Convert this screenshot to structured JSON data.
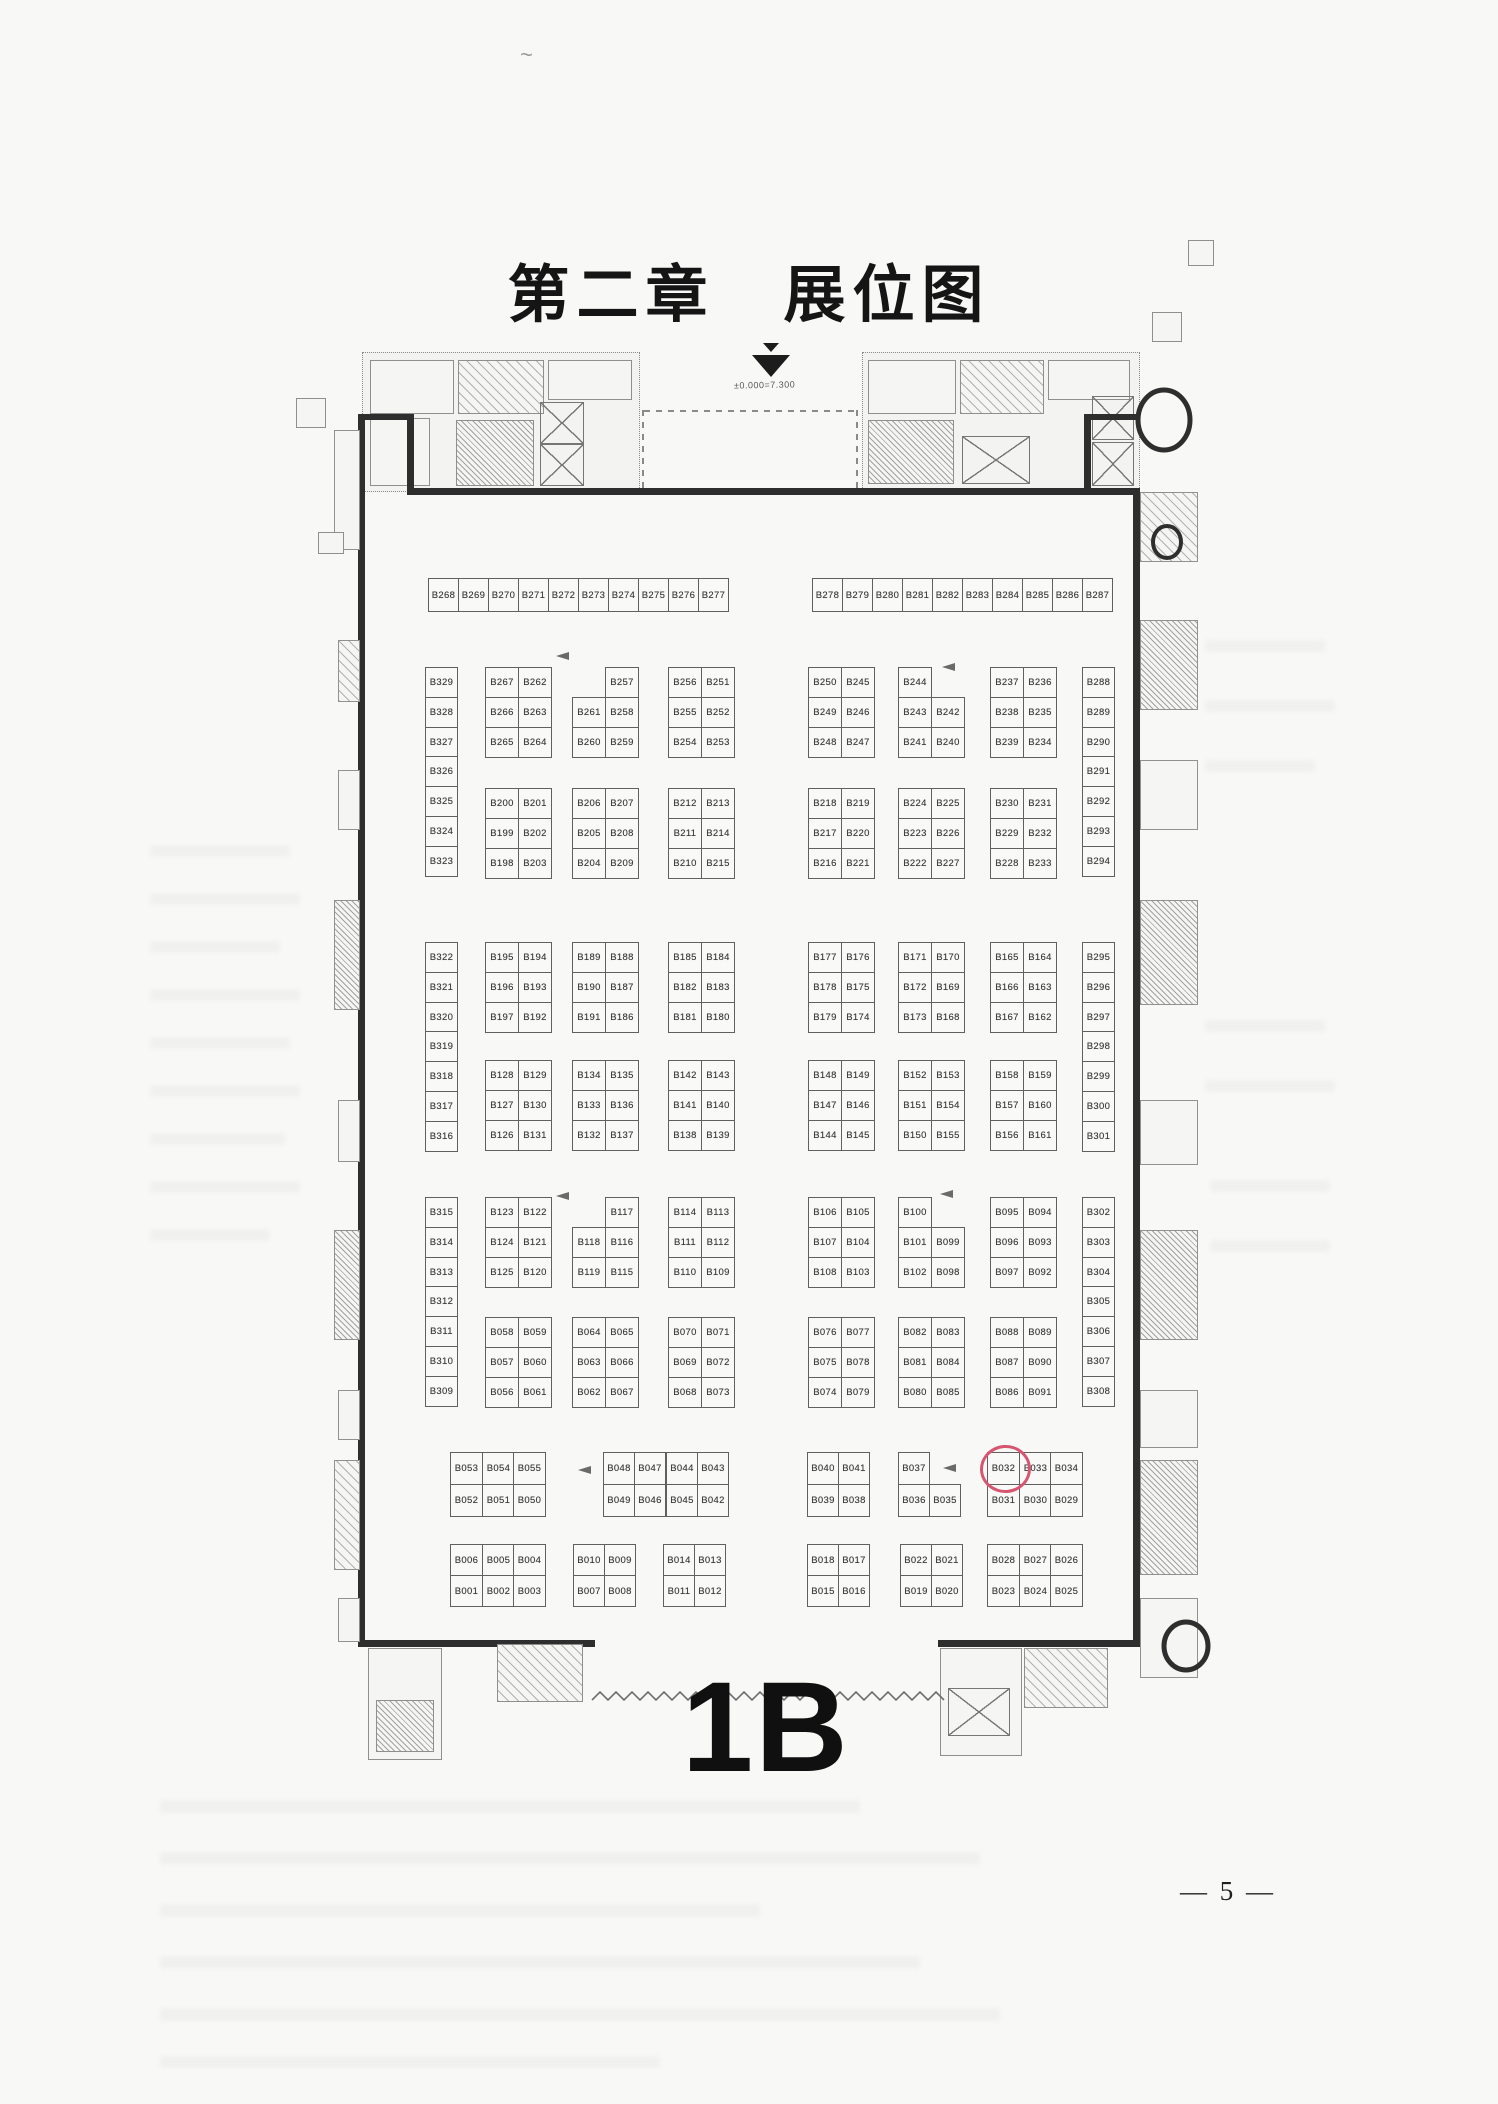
{
  "page": {
    "title": "第二章　展位图",
    "page_number": "— 5 —"
  },
  "plan": {
    "hall_label": "1B",
    "elevation_note": "±0.000=7.300",
    "highlight": {
      "booth": "B032",
      "color": "#d85570"
    },
    "blocks": [
      {
        "name": "top-row-left",
        "x": 428,
        "y": 578,
        "cw": 30,
        "ch": 33,
        "cells": [
          [
            "B268",
            "B269",
            "B270",
            "B271",
            "B272",
            "B273",
            "B274",
            "B275",
            "B276",
            "B277"
          ]
        ]
      },
      {
        "name": "top-row-right",
        "x": 812,
        "y": 578,
        "cw": 30,
        "ch": 33,
        "cells": [
          [
            "B278",
            "B279",
            "B280",
            "B281",
            "B282",
            "B283",
            "B284",
            "B285",
            "B286",
            "B287"
          ]
        ]
      },
      {
        "name": "strip-left-a",
        "x": 425,
        "y": 667,
        "cw": 32,
        "ch": 29.8,
        "cells": [
          [
            "B329"
          ],
          [
            "B328"
          ],
          [
            "B327"
          ],
          [
            "B326"
          ],
          [
            "B325"
          ],
          [
            "B324"
          ],
          [
            "B323"
          ]
        ]
      },
      {
        "name": "a1",
        "x": 485,
        "y": 667,
        "cw": 33,
        "ch": 30,
        "cells": [
          [
            "B267",
            "B262"
          ],
          [
            "B266",
            "B263"
          ],
          [
            "B265",
            "B264"
          ]
        ]
      },
      {
        "name": "a2",
        "x": 572,
        "y": 667,
        "cw": 33,
        "ch": 30,
        "cells": [
          [
            null,
            "B257"
          ],
          [
            "B261",
            "B258"
          ],
          [
            "B260",
            "B259"
          ]
        ]
      },
      {
        "name": "a3",
        "x": 668,
        "y": 667,
        "cw": 33,
        "ch": 30,
        "cells": [
          [
            "B256",
            "B251"
          ],
          [
            "B255",
            "B252"
          ],
          [
            "B254",
            "B253"
          ]
        ]
      },
      {
        "name": "a4",
        "x": 808,
        "y": 667,
        "cw": 33,
        "ch": 30,
        "cells": [
          [
            "B250",
            "B245"
          ],
          [
            "B249",
            "B246"
          ],
          [
            "B248",
            "B247"
          ]
        ]
      },
      {
        "name": "a5",
        "x": 898,
        "y": 667,
        "cw": 33,
        "ch": 30,
        "cells": [
          [
            "B244",
            null
          ],
          [
            "B243",
            "B242"
          ],
          [
            "B241",
            "B240"
          ]
        ]
      },
      {
        "name": "a6",
        "x": 990,
        "y": 667,
        "cw": 33,
        "ch": 30,
        "cells": [
          [
            "B237",
            "B236"
          ],
          [
            "B238",
            "B235"
          ],
          [
            "B239",
            "B234"
          ]
        ]
      },
      {
        "name": "strip-right-a",
        "x": 1082,
        "y": 667,
        "cw": 32,
        "ch": 29.8,
        "cells": [
          [
            "B288"
          ],
          [
            "B289"
          ],
          [
            "B290"
          ],
          [
            "B291"
          ],
          [
            "B292"
          ],
          [
            "B293"
          ],
          [
            "B294"
          ]
        ]
      },
      {
        "name": "a7",
        "x": 485,
        "y": 788,
        "cw": 33,
        "ch": 30,
        "cells": [
          [
            "B200",
            "B201"
          ],
          [
            "B199",
            "B202"
          ],
          [
            "B198",
            "B203"
          ]
        ]
      },
      {
        "name": "a8",
        "x": 572,
        "y": 788,
        "cw": 33,
        "ch": 30,
        "cells": [
          [
            "B206",
            "B207"
          ],
          [
            "B205",
            "B208"
          ],
          [
            "B204",
            "B209"
          ]
        ]
      },
      {
        "name": "a9",
        "x": 668,
        "y": 788,
        "cw": 33,
        "ch": 30,
        "cells": [
          [
            "B212",
            "B213"
          ],
          [
            "B211",
            "B214"
          ],
          [
            "B210",
            "B215"
          ]
        ]
      },
      {
        "name": "a10",
        "x": 808,
        "y": 788,
        "cw": 33,
        "ch": 30,
        "cells": [
          [
            "B218",
            "B219"
          ],
          [
            "B217",
            "B220"
          ],
          [
            "B216",
            "B221"
          ]
        ]
      },
      {
        "name": "a11",
        "x": 898,
        "y": 788,
        "cw": 33,
        "ch": 30,
        "cells": [
          [
            "B224",
            "B225"
          ],
          [
            "B223",
            "B226"
          ],
          [
            "B222",
            "B227"
          ]
        ]
      },
      {
        "name": "a12",
        "x": 990,
        "y": 788,
        "cw": 33,
        "ch": 30,
        "cells": [
          [
            "B230",
            "B231"
          ],
          [
            "B229",
            "B232"
          ],
          [
            "B228",
            "B233"
          ]
        ]
      },
      {
        "name": "strip-left-b",
        "x": 425,
        "y": 942,
        "cw": 32,
        "ch": 29.8,
        "cells": [
          [
            "B322"
          ],
          [
            "B321"
          ],
          [
            "B320"
          ],
          [
            "B319"
          ],
          [
            "B318"
          ],
          [
            "B317"
          ],
          [
            "B316"
          ]
        ]
      },
      {
        "name": "b1",
        "x": 485,
        "y": 942,
        "cw": 33,
        "ch": 30,
        "cells": [
          [
            "B195",
            "B194"
          ],
          [
            "B196",
            "B193"
          ],
          [
            "B197",
            "B192"
          ]
        ]
      },
      {
        "name": "b2",
        "x": 572,
        "y": 942,
        "cw": 33,
        "ch": 30,
        "cells": [
          [
            "B189",
            "B188"
          ],
          [
            "B190",
            "B187"
          ],
          [
            "B191",
            "B186"
          ]
        ]
      },
      {
        "name": "b3",
        "x": 668,
        "y": 942,
        "cw": 33,
        "ch": 30,
        "cells": [
          [
            "B185",
            "B184"
          ],
          [
            "B182",
            "B183"
          ],
          [
            "B181",
            "B180"
          ]
        ]
      },
      {
        "name": "b4",
        "x": 808,
        "y": 942,
        "cw": 33,
        "ch": 30,
        "cells": [
          [
            "B177",
            "B176"
          ],
          [
            "B178",
            "B175"
          ],
          [
            "B179",
            "B174"
          ]
        ]
      },
      {
        "name": "b5",
        "x": 898,
        "y": 942,
        "cw": 33,
        "ch": 30,
        "cells": [
          [
            "B171",
            "B170"
          ],
          [
            "B172",
            "B169"
          ],
          [
            "B173",
            "B168"
          ]
        ]
      },
      {
        "name": "b6",
        "x": 990,
        "y": 942,
        "cw": 33,
        "ch": 30,
        "cells": [
          [
            "B165",
            "B164"
          ],
          [
            "B166",
            "B163"
          ],
          [
            "B167",
            "B162"
          ]
        ]
      },
      {
        "name": "strip-right-b",
        "x": 1082,
        "y": 942,
        "cw": 32,
        "ch": 29.8,
        "cells": [
          [
            "B295"
          ],
          [
            "B296"
          ],
          [
            "B297"
          ],
          [
            "B298"
          ],
          [
            "B299"
          ],
          [
            "B300"
          ],
          [
            "B301"
          ]
        ]
      },
      {
        "name": "b7",
        "x": 485,
        "y": 1060,
        "cw": 33,
        "ch": 30,
        "cells": [
          [
            "B128",
            "B129"
          ],
          [
            "B127",
            "B130"
          ],
          [
            "B126",
            "B131"
          ]
        ]
      },
      {
        "name": "b8",
        "x": 572,
        "y": 1060,
        "cw": 33,
        "ch": 30,
        "cells": [
          [
            "B134",
            "B135"
          ],
          [
            "B133",
            "B136"
          ],
          [
            "B132",
            "B137"
          ]
        ]
      },
      {
        "name": "b9",
        "x": 668,
        "y": 1060,
        "cw": 33,
        "ch": 30,
        "cells": [
          [
            "B142",
            "B143"
          ],
          [
            "B141",
            "B140"
          ],
          [
            "B138",
            "B139"
          ]
        ]
      },
      {
        "name": "b10",
        "x": 808,
        "y": 1060,
        "cw": 33,
        "ch": 30,
        "cells": [
          [
            "B148",
            "B149"
          ],
          [
            "B147",
            "B146"
          ],
          [
            "B144",
            "B145"
          ]
        ]
      },
      {
        "name": "b11",
        "x": 898,
        "y": 1060,
        "cw": 33,
        "ch": 30,
        "cells": [
          [
            "B152",
            "B153"
          ],
          [
            "B151",
            "B154"
          ],
          [
            "B150",
            "B155"
          ]
        ]
      },
      {
        "name": "b12",
        "x": 990,
        "y": 1060,
        "cw": 33,
        "ch": 30,
        "cells": [
          [
            "B158",
            "B159"
          ],
          [
            "B157",
            "B160"
          ],
          [
            "B156",
            "B161"
          ]
        ]
      },
      {
        "name": "strip-left-c",
        "x": 425,
        "y": 1197,
        "cw": 32,
        "ch": 29.8,
        "cells": [
          [
            "B315"
          ],
          [
            "B314"
          ],
          [
            "B313"
          ],
          [
            "B312"
          ],
          [
            "B311"
          ],
          [
            "B310"
          ],
          [
            "B309"
          ]
        ]
      },
      {
        "name": "c1",
        "x": 485,
        "y": 1197,
        "cw": 33,
        "ch": 30,
        "cells": [
          [
            "B123",
            "B122"
          ],
          [
            "B124",
            "B121"
          ],
          [
            "B125",
            "B120"
          ]
        ]
      },
      {
        "name": "c2",
        "x": 572,
        "y": 1197,
        "cw": 33,
        "ch": 30,
        "cells": [
          [
            null,
            "B117"
          ],
          [
            "B118",
            "B116"
          ],
          [
            "B119",
            "B115"
          ]
        ]
      },
      {
        "name": "c3",
        "x": 668,
        "y": 1197,
        "cw": 33,
        "ch": 30,
        "cells": [
          [
            "B114",
            "B113"
          ],
          [
            "B111",
            "B112"
          ],
          [
            "B110",
            "B109"
          ]
        ]
      },
      {
        "name": "c4",
        "x": 808,
        "y": 1197,
        "cw": 33,
        "ch": 30,
        "cells": [
          [
            "B106",
            "B105"
          ],
          [
            "B107",
            "B104"
          ],
          [
            "B108",
            "B103"
          ]
        ]
      },
      {
        "name": "c5",
        "x": 898,
        "y": 1197,
        "cw": 33,
        "ch": 30,
        "cells": [
          [
            "B100",
            null
          ],
          [
            "B101",
            "B099"
          ],
          [
            "B102",
            "B098"
          ]
        ]
      },
      {
        "name": "c6",
        "x": 990,
        "y": 1197,
        "cw": 33,
        "ch": 30,
        "cells": [
          [
            "B095",
            "B094"
          ],
          [
            "B096",
            "B093"
          ],
          [
            "B097",
            "B092"
          ]
        ]
      },
      {
        "name": "strip-right-c",
        "x": 1082,
        "y": 1197,
        "cw": 32,
        "ch": 29.8,
        "cells": [
          [
            "B302"
          ],
          [
            "B303"
          ],
          [
            "B304"
          ],
          [
            "B305"
          ],
          [
            "B306"
          ],
          [
            "B307"
          ],
          [
            "B308"
          ]
        ]
      },
      {
        "name": "c7",
        "x": 485,
        "y": 1317,
        "cw": 33,
        "ch": 30,
        "cells": [
          [
            "B058",
            "B059"
          ],
          [
            "B057",
            "B060"
          ],
          [
            "B056",
            "B061"
          ]
        ]
      },
      {
        "name": "c8",
        "x": 572,
        "y": 1317,
        "cw": 33,
        "ch": 30,
        "cells": [
          [
            "B064",
            "B065"
          ],
          [
            "B063",
            "B066"
          ],
          [
            "B062",
            "B067"
          ]
        ]
      },
      {
        "name": "c9",
        "x": 668,
        "y": 1317,
        "cw": 33,
        "ch": 30,
        "cells": [
          [
            "B070",
            "B071"
          ],
          [
            "B069",
            "B072"
          ],
          [
            "B068",
            "B073"
          ]
        ]
      },
      {
        "name": "c10",
        "x": 808,
        "y": 1317,
        "cw": 33,
        "ch": 30,
        "cells": [
          [
            "B076",
            "B077"
          ],
          [
            "B075",
            "B078"
          ],
          [
            "B074",
            "B079"
          ]
        ]
      },
      {
        "name": "c11",
        "x": 898,
        "y": 1317,
        "cw": 33,
        "ch": 30,
        "cells": [
          [
            "B082",
            "B083"
          ],
          [
            "B081",
            "B084"
          ],
          [
            "B080",
            "B085"
          ]
        ]
      },
      {
        "name": "c12",
        "x": 990,
        "y": 1317,
        "cw": 33,
        "ch": 30,
        "cells": [
          [
            "B088",
            "B089"
          ],
          [
            "B087",
            "B090"
          ],
          [
            "B086",
            "B091"
          ]
        ]
      },
      {
        "name": "d1",
        "x": 450,
        "y": 1452,
        "cw": 31.7,
        "ch": 32,
        "cells": [
          [
            "B053",
            "B054",
            "B055"
          ],
          [
            "B052",
            "B051",
            "B050"
          ]
        ]
      },
      {
        "name": "d2",
        "x": 603,
        "y": 1452,
        "cw": 31.3,
        "ch": 32,
        "cells": [
          [
            "B048",
            "B047",
            "B044",
            "B043"
          ],
          [
            "B049",
            "B046",
            "B045",
            "B042"
          ]
        ]
      },
      {
        "name": "d3",
        "x": 807,
        "y": 1452,
        "cw": 31,
        "ch": 32,
        "cells": [
          [
            "B040",
            "B041"
          ],
          [
            "B039",
            "B038"
          ]
        ]
      },
      {
        "name": "d4",
        "x": 898,
        "y": 1452,
        "cw": 31,
        "ch": 32,
        "cells": [
          [
            "B037",
            null
          ],
          [
            "B036",
            "B035"
          ]
        ]
      },
      {
        "name": "d5",
        "x": 987,
        "y": 1452,
        "cw": 31.7,
        "ch": 32,
        "cells": [
          [
            "B032",
            "B033",
            "B034"
          ],
          [
            "B031",
            "B030",
            "B029"
          ]
        ]
      },
      {
        "name": "e1",
        "x": 450,
        "y": 1544,
        "cw": 31.7,
        "ch": 31,
        "cells": [
          [
            "B006",
            "B005",
            "B004"
          ],
          [
            "B001",
            "B002",
            "B003"
          ]
        ]
      },
      {
        "name": "e2",
        "x": 573,
        "y": 1544,
        "cw": 31,
        "ch": 31,
        "cells": [
          [
            "B010",
            "B009"
          ],
          [
            "B007",
            "B008"
          ]
        ]
      },
      {
        "name": "e3",
        "x": 663,
        "y": 1544,
        "cw": 31,
        "ch": 31,
        "cells": [
          [
            "B014",
            "B013"
          ],
          [
            "B011",
            "B012"
          ]
        ]
      },
      {
        "name": "e4",
        "x": 807,
        "y": 1544,
        "cw": 31,
        "ch": 31,
        "cells": [
          [
            "B018",
            "B017"
          ],
          [
            "B015",
            "B016"
          ]
        ]
      },
      {
        "name": "e5",
        "x": 900,
        "y": 1544,
        "cw": 31,
        "ch": 31,
        "cells": [
          [
            "B022",
            "B021"
          ],
          [
            "B019",
            "B020"
          ]
        ]
      },
      {
        "name": "e6",
        "x": 987,
        "y": 1544,
        "cw": 31.7,
        "ch": 31,
        "cells": [
          [
            "B028",
            "B027",
            "B026"
          ],
          [
            "B023",
            "B024",
            "B025"
          ]
        ]
      }
    ]
  }
}
